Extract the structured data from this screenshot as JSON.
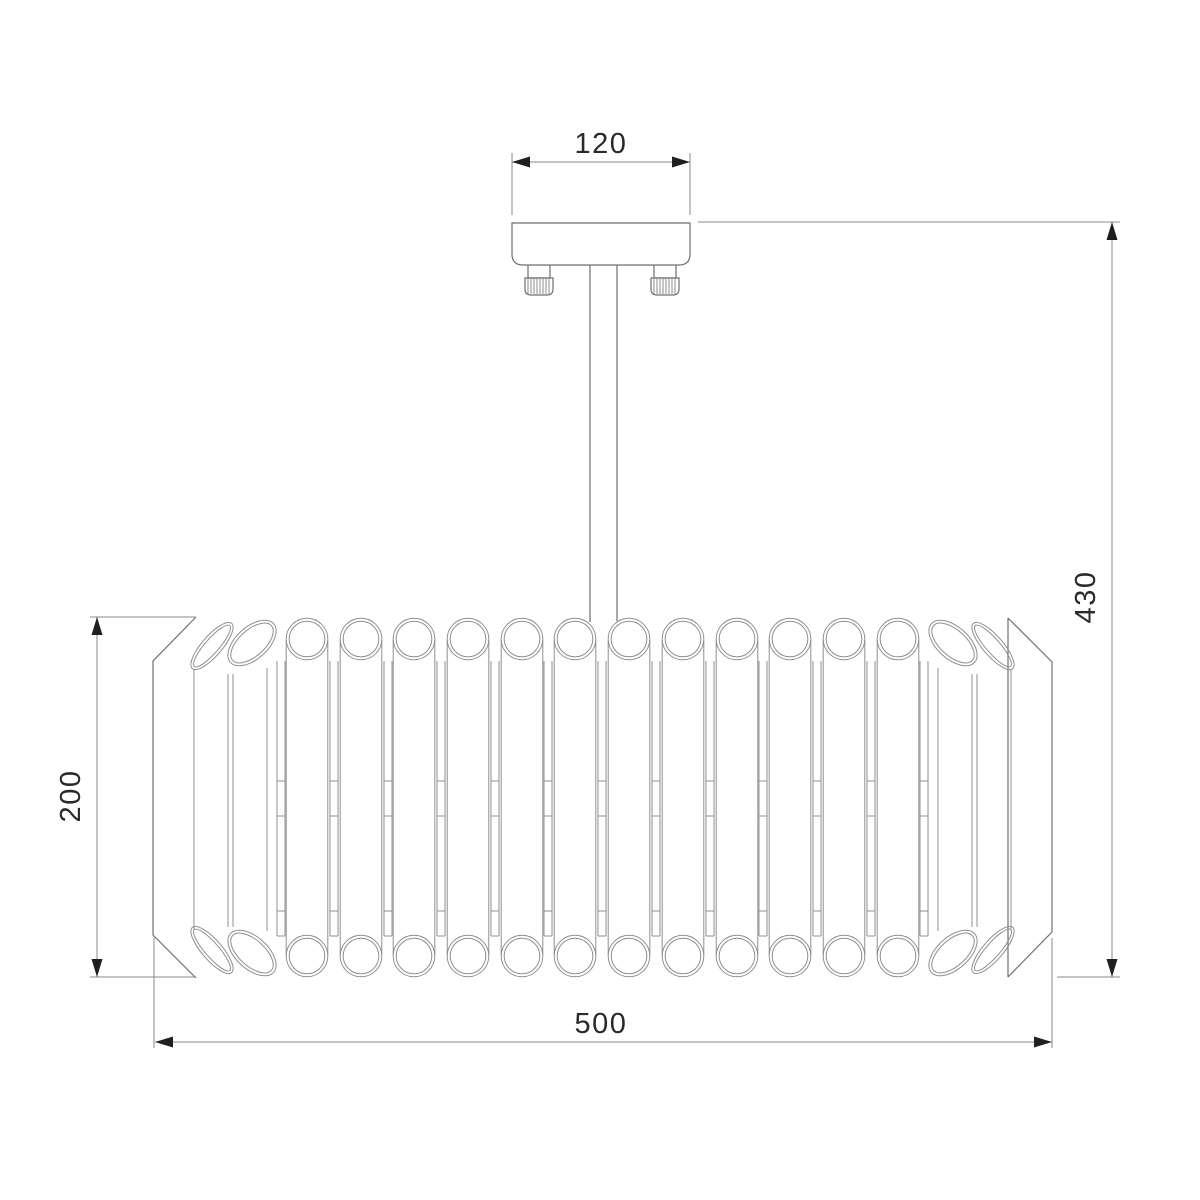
{
  "drawing": {
    "dimensions": {
      "canopy_width": {
        "label": "120"
      },
      "total_height": {
        "label": "430"
      },
      "shade_height": {
        "label": "200"
      },
      "shade_width": {
        "label": "500"
      }
    },
    "colors": {
      "background": "#ffffff",
      "structure_lines": "#6f6f6f",
      "tube_lines": "#8f8f8f",
      "dimension_lines": "#8a8a8a",
      "dimension_text": "#2a2a2a"
    }
  }
}
